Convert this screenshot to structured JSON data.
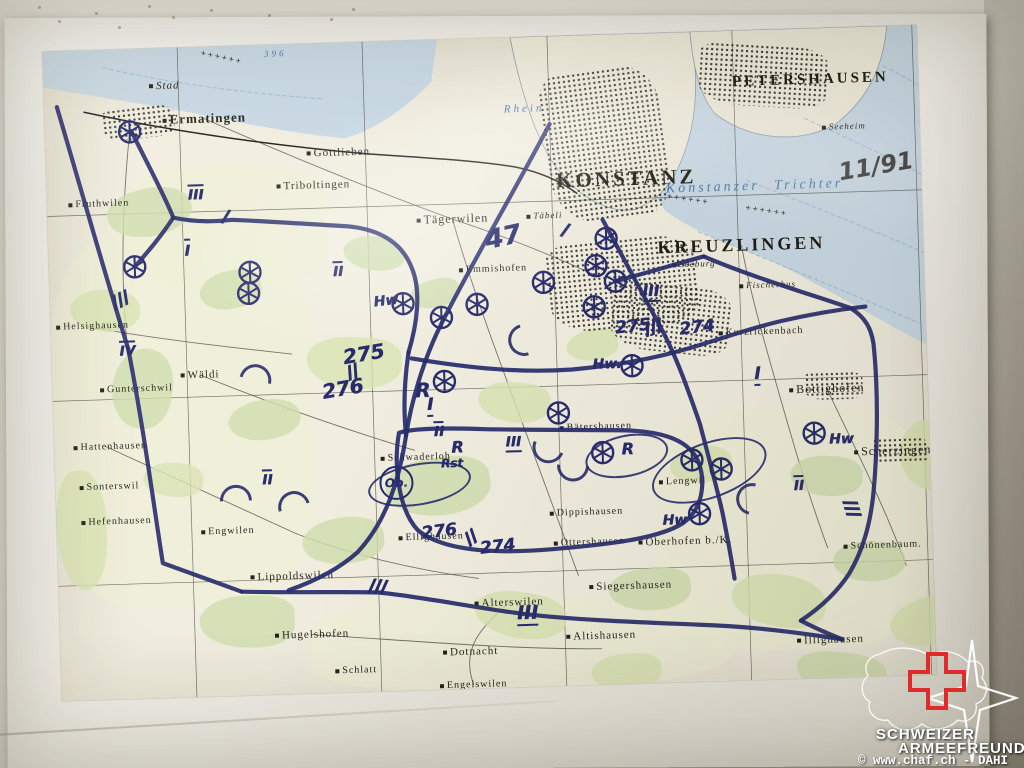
{
  "photo": {
    "wall_top_color": "#e9e6de",
    "wall_right_color": "#b5b1a6",
    "sheet_color": "#f3f1ea",
    "wall_specks": [
      [
        38,
        6
      ],
      [
        58,
        20
      ],
      [
        95,
        12
      ],
      [
        118,
        26
      ],
      [
        148,
        5
      ],
      [
        172,
        16
      ],
      [
        210,
        9
      ],
      [
        268,
        14
      ],
      [
        330,
        18
      ],
      [
        352,
        8
      ]
    ]
  },
  "watermark": {
    "org_line1": "SCHWEIZER",
    "org_line2": "ARMEEFREUNDE",
    "copyright": "© www.chaf.ch - DAHI",
    "cross_color": "#e02b2b",
    "outline_color": "#ffffff"
  },
  "map": {
    "note": "11/91",
    "ink_color": "#272b6d",
    "paper_color": "#f1eee0",
    "water_color": "#c9d9e5",
    "major_labels": [
      {
        "text": "KONSTANZ",
        "x": 580,
        "y": 145,
        "size": 21
      },
      {
        "text": "KREUZLINGEN",
        "x": 693,
        "y": 215,
        "size": 18
      },
      {
        "text": "PETERSHAUSEN",
        "x": 767,
        "y": 52,
        "size": 15
      }
    ],
    "water_labels": [
      {
        "text": "Konstanzer Trichter",
        "x": 708,
        "y": 157,
        "size": 14
      },
      {
        "text": "Rhein",
        "x": 480,
        "y": 72,
        "size": 11
      },
      {
        "text": "396",
        "x": 233,
        "y": 9,
        "size": 9
      }
    ],
    "places": [
      {
        "text": "Stad",
        "x": 121,
        "y": 38,
        "size": 11,
        "italic": true
      },
      {
        "text": "Ermatingen",
        "x": 160,
        "y": 72,
        "size": 13,
        "bold": true
      },
      {
        "text": "Triboltingen",
        "x": 267,
        "y": 142,
        "size": 11
      },
      {
        "text": "Gottlieben",
        "x": 293,
        "y": 110,
        "size": 11
      },
      {
        "text": "Tägerwilen",
        "x": 405,
        "y": 180,
        "size": 12
      },
      {
        "text": "Täbeli",
        "x": 497,
        "y": 179,
        "size": 9,
        "italic": true
      },
      {
        "text": "Emmishofen",
        "x": 444,
        "y": 231,
        "size": 10
      },
      {
        "text": "Fruthwilen",
        "x": 52,
        "y": 154,
        "size": 10
      },
      {
        "text": "Helsighausen",
        "x": 42,
        "y": 276,
        "size": 10
      },
      {
        "text": "Gunterschwil",
        "x": 84,
        "y": 340,
        "size": 10
      },
      {
        "text": "Wäldi",
        "x": 148,
        "y": 328,
        "size": 11
      },
      {
        "text": "Hattenhausen",
        "x": 56,
        "y": 397,
        "size": 10
      },
      {
        "text": "Sonterswil",
        "x": 54,
        "y": 437,
        "size": 10
      },
      {
        "text": "Hefenhausen",
        "x": 60,
        "y": 472,
        "size": 10
      },
      {
        "text": "Engwilen",
        "x": 171,
        "y": 485,
        "size": 10
      },
      {
        "text": "Schwaderloh",
        "x": 361,
        "y": 417,
        "size": 10
      },
      {
        "text": "Bätershausen",
        "x": 542,
        "y": 392,
        "size": 10
      },
      {
        "text": "Seeburg",
        "x": 645,
        "y": 232,
        "size": 9,
        "italic": true
      },
      {
        "text": "Fischerhus",
        "x": 718,
        "y": 255,
        "size": 9,
        "italic": true
      },
      {
        "text": "Seeheim",
        "x": 799,
        "y": 99,
        "size": 9,
        "italic": true
      },
      {
        "text": "Kurzrickenbach",
        "x": 710,
        "y": 302,
        "size": 10
      },
      {
        "text": "Bottighofen",
        "x": 774,
        "y": 361,
        "size": 12
      },
      {
        "text": "Scherzingen",
        "x": 838,
        "y": 425,
        "size": 12
      },
      {
        "text": "Lengwil",
        "x": 627,
        "y": 449,
        "size": 10
      },
      {
        "text": "Oberhofen b./K.",
        "x": 628,
        "y": 509,
        "size": 11
      },
      {
        "text": "Dippishausen",
        "x": 530,
        "y": 477,
        "size": 10
      },
      {
        "text": "Ottershausen",
        "x": 532,
        "y": 507,
        "size": 10
      },
      {
        "text": "Ellighausen",
        "x": 374,
        "y": 497,
        "size": 10
      },
      {
        "text": "Alterswilen",
        "x": 450,
        "y": 565,
        "size": 11
      },
      {
        "text": "Siegershausen",
        "x": 572,
        "y": 552,
        "size": 11
      },
      {
        "text": "Altishausen",
        "x": 541,
        "y": 601,
        "size": 11
      },
      {
        "text": "Dotnacht",
        "x": 410,
        "y": 613,
        "size": 11
      },
      {
        "text": "Hugelshofen",
        "x": 252,
        "y": 591,
        "size": 11
      },
      {
        "text": "Lippoldswilen",
        "x": 234,
        "y": 532,
        "size": 11
      },
      {
        "text": "Illighausen",
        "x": 770,
        "y": 612,
        "size": 11
      },
      {
        "text": "Schönenbaum.",
        "x": 825,
        "y": 519,
        "size": 10
      },
      {
        "text": "Schlatt",
        "x": 295,
        "y": 628,
        "size": 10
      },
      {
        "text": "Engelswilen",
        "x": 412,
        "y": 646,
        "size": 10
      }
    ],
    "annotations": [
      {
        "t": "47",
        "x": 455,
        "y": 200,
        "s": 26,
        "d": "",
        "r": -10
      },
      {
        "t": "275",
        "x": 312,
        "y": 312,
        "s": 20,
        "d": "",
        "r": -8
      },
      {
        "t": "276",
        "x": 290,
        "y": 346,
        "s": 20,
        "d": "",
        "r": -8
      },
      {
        "t": "R",
        "x": 370,
        "y": 350,
        "s": 20,
        "d": "",
        "r": 0
      },
      {
        "t": "I",
        "x": 377,
        "y": 366,
        "s": 17,
        "d": "under",
        "r": 0
      },
      {
        "t": "Hw",
        "x": 336,
        "y": 260,
        "s": 14,
        "d": "",
        "r": -5
      },
      {
        "t": "275",
        "x": 582,
        "y": 293,
        "s": 17,
        "d": "",
        "r": -5
      },
      {
        "t": "274",
        "x": 646,
        "y": 296,
        "s": 17,
        "d": "",
        "r": -5
      },
      {
        "t": "III",
        "x": 601,
        "y": 259,
        "s": 15,
        "d": "under",
        "r": 0
      },
      {
        "t": "Hw.",
        "x": 555,
        "y": 330,
        "s": 14,
        "d": "",
        "r": 0
      },
      {
        "t": "II",
        "x": 385,
        "y": 391,
        "s": 14,
        "d": "over",
        "r": 0
      },
      {
        "t": "R",
        "x": 403,
        "y": 408,
        "s": 16,
        "d": "",
        "r": 0
      },
      {
        "t": "Rst",
        "x": 397,
        "y": 424,
        "s": 12,
        "d": "",
        "r": 0
      },
      {
        "t": "III",
        "x": 459,
        "y": 406,
        "s": 14,
        "d": "under",
        "r": 0
      },
      {
        "t": "R",
        "x": 573,
        "y": 415,
        "s": 16,
        "d": "",
        "r": 0
      },
      {
        "t": "II",
        "x": 212,
        "y": 434,
        "s": 14,
        "d": "over",
        "r": 0
      },
      {
        "t": "I",
        "x": 705,
        "y": 345,
        "s": 17,
        "d": "under",
        "r": 0
      },
      {
        "t": "II",
        "x": 743,
        "y": 456,
        "s": 14,
        "d": "over",
        "r": 0
      },
      {
        "t": "Hw",
        "x": 618,
        "y": 488,
        "s": 14,
        "d": "",
        "r": 0
      },
      {
        "t": "Hw",
        "x": 787,
        "y": 412,
        "s": 14,
        "d": "",
        "r": 0
      },
      {
        "t": "III",
        "x": 468,
        "y": 577,
        "s": 19,
        "d": "under",
        "r": 0
      },
      {
        "t": "276",
        "x": 382,
        "y": 492,
        "s": 17,
        "d": "",
        "r": -5
      },
      {
        "t": "274",
        "x": 440,
        "y": 509,
        "s": 17,
        "d": "",
        "r": -5
      },
      {
        "t": "III",
        "x": 149,
        "y": 147,
        "s": 14,
        "d": "over",
        "r": 0
      },
      {
        "t": "I",
        "x": 139,
        "y": 202,
        "s": 15,
        "d": "over",
        "r": 0
      },
      {
        "t": "IV",
        "x": 76,
        "y": 301,
        "s": 14,
        "d": "over",
        "r": 0
      },
      {
        "t": "II",
        "x": 289,
        "y": 228,
        "s": 14,
        "d": "over",
        "r": 0
      }
    ],
    "tick_marks": [
      {
        "x": 302,
        "y": 329,
        "n": 2,
        "r": -20
      },
      {
        "x": 604,
        "y": 294,
        "n": 3,
        "r": -15
      },
      {
        "x": 415,
        "y": 498,
        "n": 2,
        "r": -35
      },
      {
        "x": 72,
        "y": 250,
        "n": 3,
        "r": -25
      },
      {
        "x": 180,
        "y": 171,
        "n": 1,
        "r": 15
      },
      {
        "x": 519,
        "y": 195,
        "n": 1,
        "r": 20
      },
      {
        "x": 321,
        "y": 545,
        "n": 3,
        "r": 8
      },
      {
        "x": 796,
        "y": 483,
        "n": 3,
        "r": 75
      }
    ],
    "wheels": [
      [
        85,
        83
      ],
      [
        86,
        218
      ],
      [
        201,
        227
      ],
      [
        199,
        248
      ],
      [
        353,
        263
      ],
      [
        391,
        278
      ],
      [
        427,
        266
      ],
      [
        494,
        246
      ],
      [
        558,
        204
      ],
      [
        547,
        231
      ],
      [
        566,
        247
      ],
      [
        544,
        272
      ],
      [
        505,
        377
      ],
      [
        392,
        342
      ],
      [
        548,
        418
      ],
      [
        580,
        332
      ],
      [
        637,
        428
      ],
      [
        666,
        438
      ],
      [
        643,
        482
      ],
      [
        760,
        405
      ]
    ],
    "labeled_circles": [
      {
        "text": "Ob.",
        "x": 341,
        "y": 442,
        "r": 15
      }
    ],
    "ellipses": [
      {
        "x": 362,
        "y": 442,
        "rx": 50,
        "ry": 19,
        "rot": -8
      },
      {
        "x": 652,
        "y": 437,
        "rx": 58,
        "ry": 26,
        "rot": -18
      },
      {
        "x": 570,
        "y": 420,
        "rx": 40,
        "ry": 19,
        "rot": -10
      }
    ],
    "arcs": [
      {
        "x": 177,
        "y": 452,
        "r": -45
      },
      {
        "x": 235,
        "y": 460,
        "r": -60
      },
      {
        "x": 200,
        "y": 332,
        "r": -30
      },
      {
        "x": 491,
        "y": 408,
        "r": 160
      },
      {
        "x": 515,
        "y": 427,
        "r": 140
      },
      {
        "x": 693,
        "y": 466,
        "r": -120
      },
      {
        "x": 470,
        "y": 300,
        "r": -150
      }
    ],
    "ink_paths": [
      "M13,56 C35,140 60,240 77,300 C90,380 98,460 105,515 L183,546",
      "M183,546 C240,549 290,549 320,551 C360,556 420,570 465,577 C520,585 585,589 640,593 C690,596 740,604 782,612",
      "M505,88 C470,150 420,230 392,282 C372,318 358,362 352,395 C344,438 330,480 300,510 C280,527 255,538 230,546",
      "M87,83 C103,118 118,148 126,170 C150,176 170,175 185,174 C225,177 265,181 300,184 C332,188 354,202 363,228 C372,252 366,285 357,312",
      "M357,312 C352,340 350,368 352,395",
      "M360,318 C420,330 470,336 520,334 C565,331 600,326 635,317 C670,308 700,298 730,292 C760,286 790,282 815,280",
      "M555,185 C575,225 595,265 610,295 C625,325 636,360 646,392 C653,422 660,452 666,482 C670,506 673,525 676,548",
      "M655,225 C700,246 760,266 800,281 C815,291 820,302 822,317 C826,370 822,432 817,470 C813,497 806,522 791,546 C776,568 757,582 741,592",
      "M741,592 C755,600 768,606 782,612",
      "M345,392 C338,426 343,470 361,490 C386,512 440,516 495,513 C550,510 601,506 626,491 C646,478 651,451 643,429 C633,405 601,397 561,396 C511,394 471,393 431,391 C401,389 361,387 345,392",
      "M566,247 C596,240 626,232 655,225",
      "M126,170 C112,190 98,205 86,218"
    ],
    "railways": [
      "M40,62 C120,82 220,100 320,112 C380,118 430,122 470,130 C495,136 515,146 530,158"
    ],
    "roads": [
      "M160,72 C240,110 330,150 405,180 C460,200 505,220 545,240",
      "M52,397 C120,430 180,460 240,490 C300,515 360,530 420,540",
      "M148,328 C220,360 300,390 360,410",
      "M405,180 C420,240 440,300 460,360 C480,420 500,480 520,540",
      "M774,361 C800,420 828,480 848,540",
      "M693,215 C700,260 710,300 720,340 C735,400 750,460 770,520",
      "M252,591 C350,600 450,612 541,614",
      "M35,276 C100,290 170,300 240,310",
      "M85,83 C75,160 70,240 78,320",
      "M450,565 C420,590 400,610 412,646"
    ],
    "border_marks": [
      {
        "x": 158,
        "y": 6,
        "r": 14
      },
      {
        "x": 620,
        "y": 162,
        "r": 10
      },
      {
        "x": 698,
        "y": 176,
        "r": 10
      }
    ],
    "grid": {
      "x": [
        135,
        320,
        505,
        690,
        870
      ],
      "y": [
        165,
        350,
        535
      ]
    },
    "water_polys": [
      "M0,0 L395,0 L388,42 C360,70 330,88 300,96 C250,90 190,76 140,64 C90,54 40,44 0,36 Z",
      "M505,0 L875,0 L875,320 C830,295 780,262 720,230 C675,212 640,196 618,178 C600,152 582,112 562,72 C552,48 540,22 532,0 Z"
    ],
    "land_polys": [
      "M468,0 L648,0 C656,42 652,84 642,112 C630,148 614,166 588,176 C558,180 528,158 508,128 C488,96 476,48 468,0 Z",
      "M648,0 L845,0 C840,42 824,72 792,96 C752,118 700,108 670,82 C654,60 650,30 648,0 Z"
    ],
    "lake_contours": [
      "M650,200 C720,230 790,262 868,298",
      "M700,150 C770,180 850,215 875,228",
      "M760,90 C820,120 875,148 875,150",
      "M840,40 C862,52 875,60 875,62",
      "M60,18 C120,34 200,48 280,56"
    ],
    "city_areas": [
      {
        "x": 500,
        "y": 35,
        "w": 120,
        "h": 150,
        "rot": -6
      },
      {
        "x": 498,
        "y": 205,
        "w": 150,
        "h": 90,
        "rot": -4
      },
      {
        "x": 560,
        "y": 252,
        "w": 120,
        "h": 68,
        "rot": 8
      },
      {
        "x": 655,
        "y": 15,
        "w": 130,
        "h": 62,
        "rot": 5
      },
      {
        "x": 58,
        "y": 58,
        "w": 72,
        "h": 32,
        "rot": -5
      },
      {
        "x": 752,
        "y": 344,
        "w": 58,
        "h": 28,
        "rot": 0
      },
      {
        "x": 818,
        "y": 412,
        "w": 56,
        "h": 26,
        "rot": 0
      }
    ],
    "forests": [
      [
        60,
        140,
        85,
        48
      ],
      [
        20,
        240,
        70,
        42
      ],
      [
        150,
        225,
        62,
        38
      ],
      [
        255,
        295,
        95,
        52
      ],
      [
        175,
        355,
        72,
        40
      ],
      [
        88,
        415,
        60,
        34
      ],
      [
        330,
        418,
        105,
        58
      ],
      [
        425,
        345,
        72,
        40
      ],
      [
        245,
        475,
        82,
        46
      ],
      [
        415,
        555,
        92,
        46
      ],
      [
        550,
        535,
        82,
        42
      ],
      [
        672,
        545,
        95,
        52
      ],
      [
        775,
        515,
        72,
        40
      ],
      [
        830,
        572,
        85,
        48
      ],
      [
        140,
        550,
        95,
        52
      ],
      [
        615,
        415,
        62,
        36
      ],
      [
        735,
        428,
        72,
        40
      ],
      [
        515,
        295,
        52,
        30
      ],
      [
        295,
        195,
        62,
        34
      ],
      [
        845,
        395,
        60,
        70
      ],
      [
        735,
        625,
        90,
        40
      ],
      [
        530,
        620,
        70,
        36
      ],
      [
        60,
        300,
        60,
        80
      ],
      [
        0,
        420,
        50,
        120
      ],
      [
        360,
        240,
        50,
        28
      ]
    ],
    "field_washes": [
      [
        0,
        180,
        260,
        380
      ],
      [
        600,
        380,
        270,
        240
      ],
      [
        250,
        560,
        420,
        90
      ],
      [
        80,
        120,
        200,
        120
      ]
    ]
  }
}
